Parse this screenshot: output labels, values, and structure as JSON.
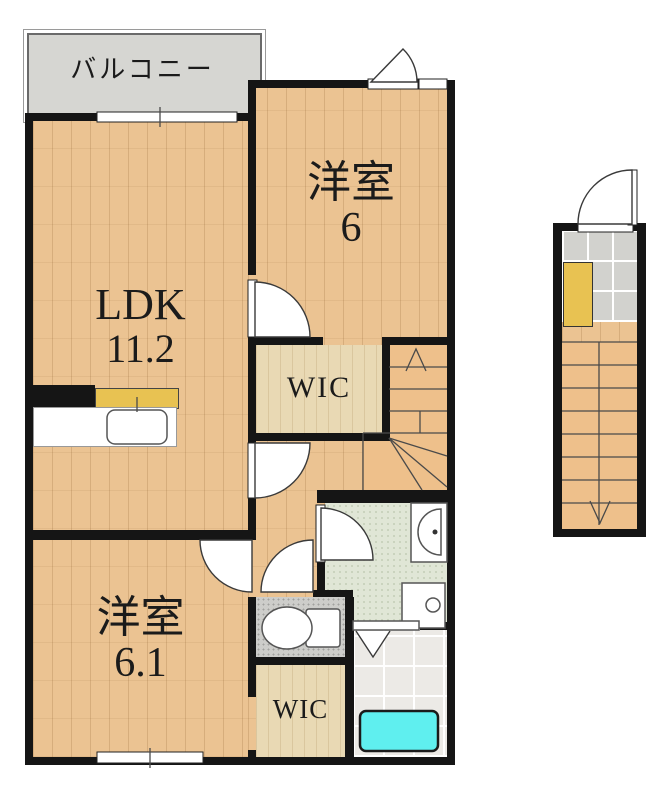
{
  "plan_title": "2F apartment floor plan",
  "rooms": [
    {
      "id": "balcony",
      "label": "バルコニー"
    },
    {
      "id": "western-room-6",
      "label": "洋室",
      "area": "6"
    },
    {
      "id": "ldk",
      "label": "LDK",
      "area": "11.2"
    },
    {
      "id": "wic-upper",
      "label": "WIC"
    },
    {
      "id": "western-room-6-1",
      "label": "洋室",
      "area": "6.1"
    },
    {
      "id": "wic-lower",
      "label": "WIC"
    }
  ],
  "stairs": {
    "main_direction": "up",
    "entrance_direction": "down"
  },
  "fixtures": [
    "kitchen-sink",
    "toilet",
    "washbasin",
    "washing-machine",
    "bathtub",
    "shoe-cabinet",
    "folding-door"
  ],
  "colors": {
    "wall": "#151515",
    "wood": "#ebc392",
    "wic": "#e9d9b4",
    "stairs": "#eec08b",
    "balcony": "#d6d6d2",
    "tile_grey": "#d2d2ce",
    "toilet_floor": "#cdcdca",
    "washroom_floor": "#e0e6d6",
    "bath_floor": "#eceae6",
    "bathtub": "#5fefef",
    "cabinet": "#e8c252",
    "counter": "#ffffff"
  }
}
